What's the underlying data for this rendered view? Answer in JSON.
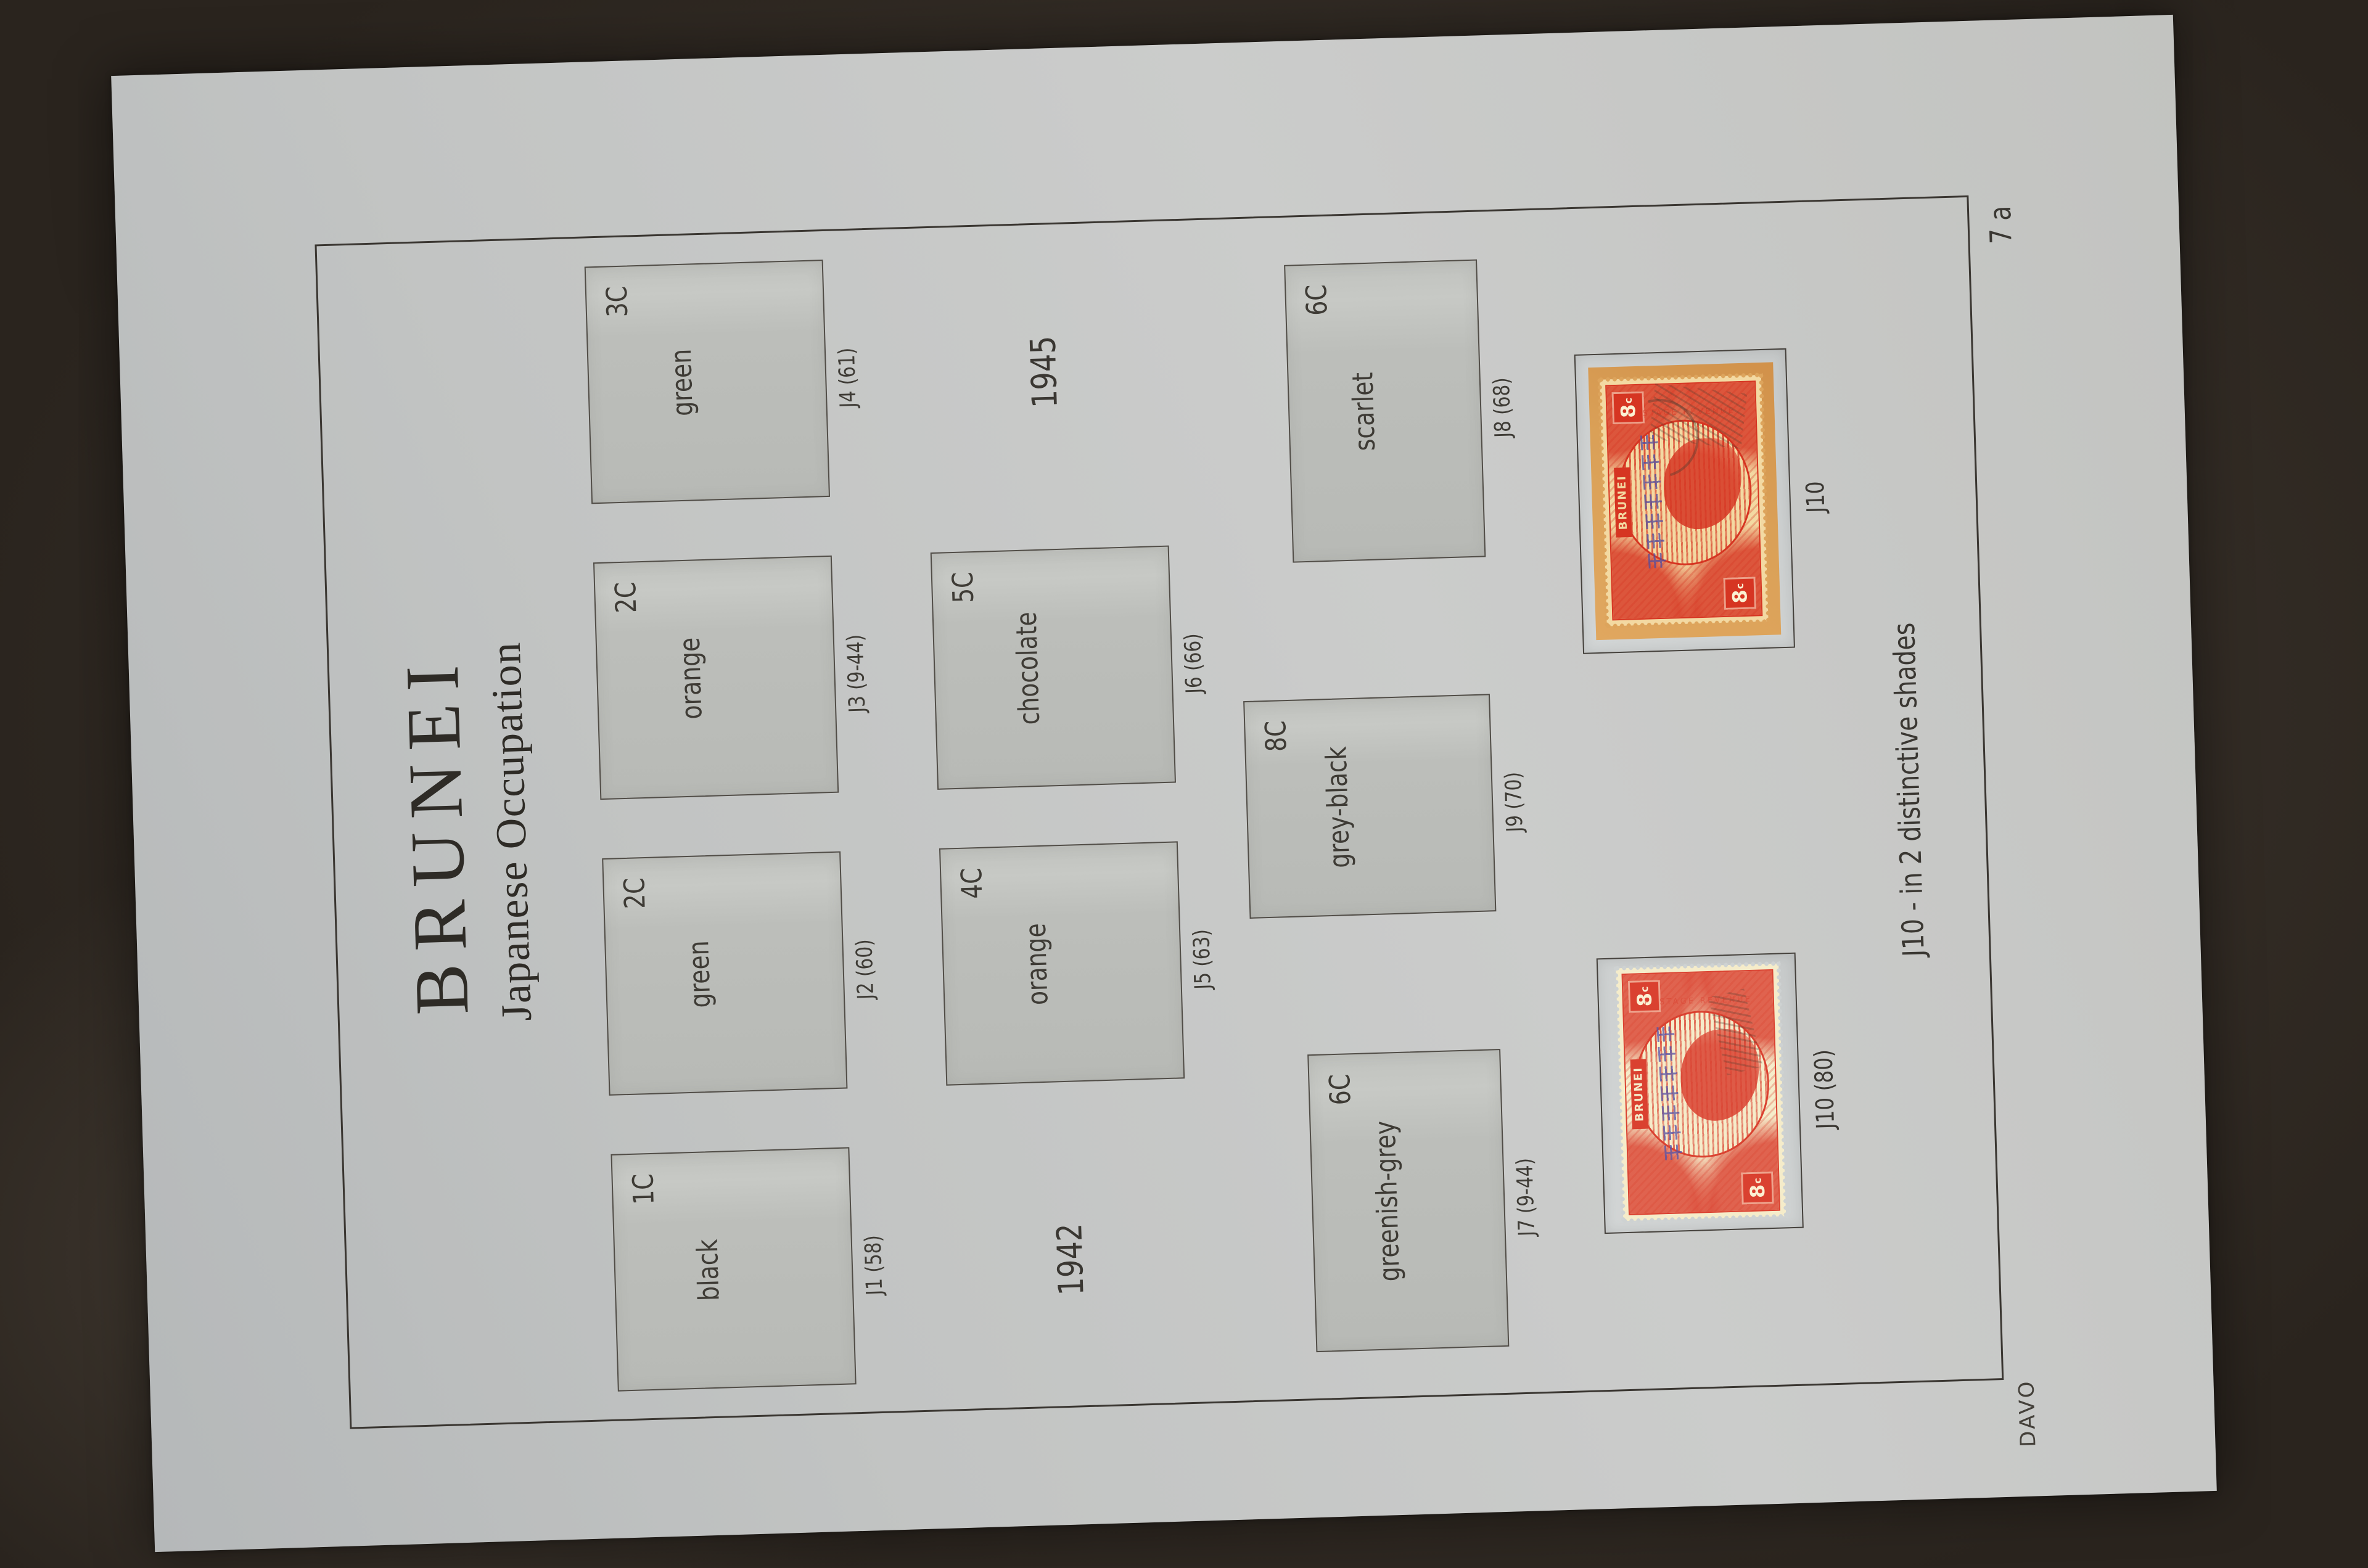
{
  "photo": {
    "background_color": "#362f28",
    "paper_color": "#c2c4c3"
  },
  "page": {
    "title": "BRUNEI",
    "subtitle": "Japanese Occupation",
    "page_number": "7 a",
    "publisher": "DAVO",
    "footnote": "J10 - in 2 distinctive shades",
    "year_left": "1942",
    "year_right": "1945",
    "boxes": [
      {
        "id": "J1",
        "color_name": "black",
        "value": "1C",
        "caption": "J1 (58)"
      },
      {
        "id": "J2",
        "color_name": "green",
        "value": "2C",
        "caption": "J2 (60)"
      },
      {
        "id": "J3",
        "color_name": "orange",
        "value": "2C",
        "caption": "J3 (9-44)"
      },
      {
        "id": "J4",
        "color_name": "green",
        "value": "3C",
        "caption": "J4 (61)"
      },
      {
        "id": "J5",
        "color_name": "orange",
        "value": "4C",
        "caption": "J5 (63)"
      },
      {
        "id": "J6",
        "color_name": "chocolate",
        "value": "5C",
        "caption": "J6 (66)"
      },
      {
        "id": "J7",
        "color_name": "greenish-grey",
        "value": "6C",
        "caption": "J7 (9-44)"
      },
      {
        "id": "J9",
        "color_name": "grey-black",
        "value": "8C",
        "caption": "J9 (70)"
      },
      {
        "id": "J8",
        "color_name": "scarlet",
        "value": "6C",
        "caption": "J8 (68)"
      }
    ],
    "stamps": [
      {
        "caption": "J10 (80)",
        "country": "BRUNEI",
        "denomination": "8",
        "currency": "c",
        "overprint": "大日本帝國政府",
        "side_text": "POSTAGE REVENUE",
        "shade": "pale cream"
      },
      {
        "caption": "J10",
        "country": "BRUNEI",
        "denomination": "8",
        "currency": "c",
        "overprint": "大日本帝國政府",
        "side_text": "POSTAGE REVENUE",
        "shade": "on orange piece"
      }
    ],
    "colors": {
      "stamp_red": "#d9402c",
      "overprint_violet": "#5a54a6",
      "piece_orange": "#dda45c",
      "stamp_cream": "#f5ecca"
    }
  }
}
